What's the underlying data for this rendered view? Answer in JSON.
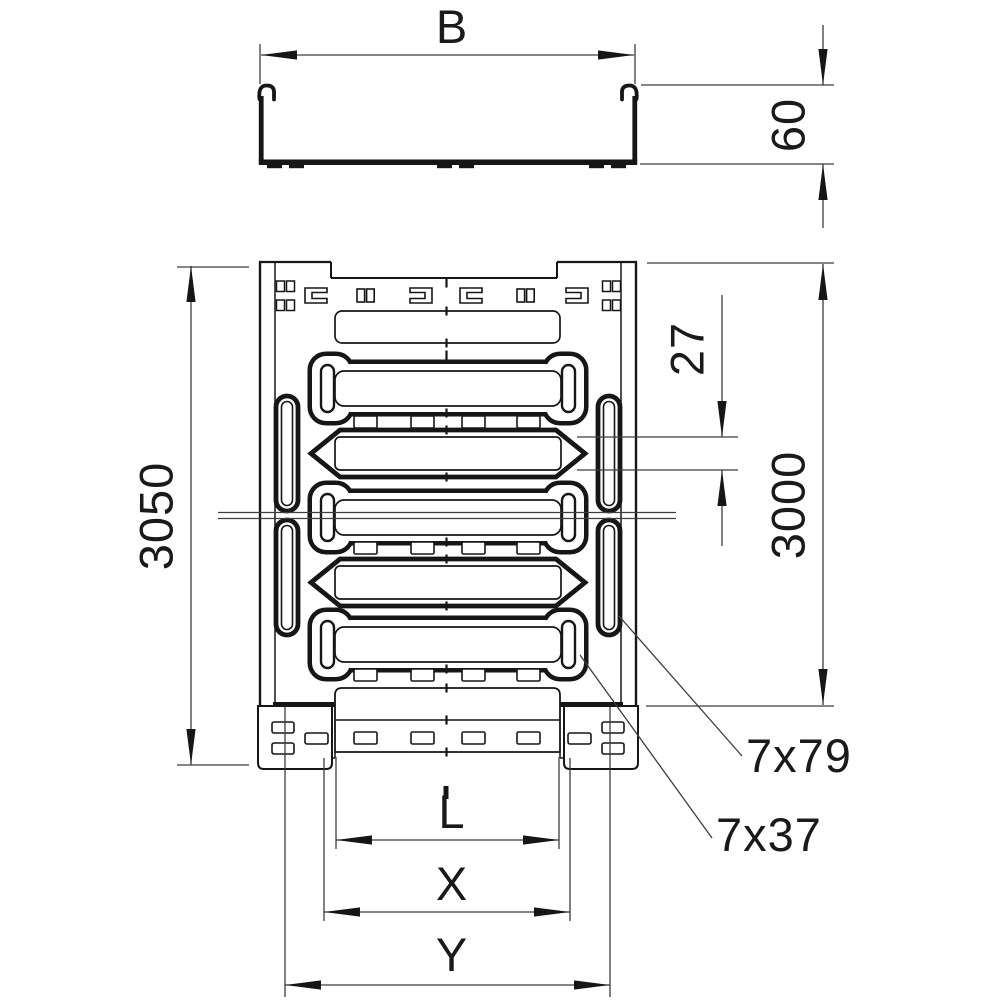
{
  "drawing": {
    "labels": {
      "width": "B",
      "height": "60",
      "overall_length": "3050",
      "perforation_length": "3000",
      "slot_width": "27",
      "side_slot": "7x79",
      "bottom_slot": "7x37",
      "dim_l": "L",
      "dim_x": "X",
      "dim_y": "Y"
    },
    "colors": {
      "line": "#161616",
      "dim_line": "#3d3d3d",
      "text": "#1a1a1a",
      "background": "#ffffff"
    }
  }
}
